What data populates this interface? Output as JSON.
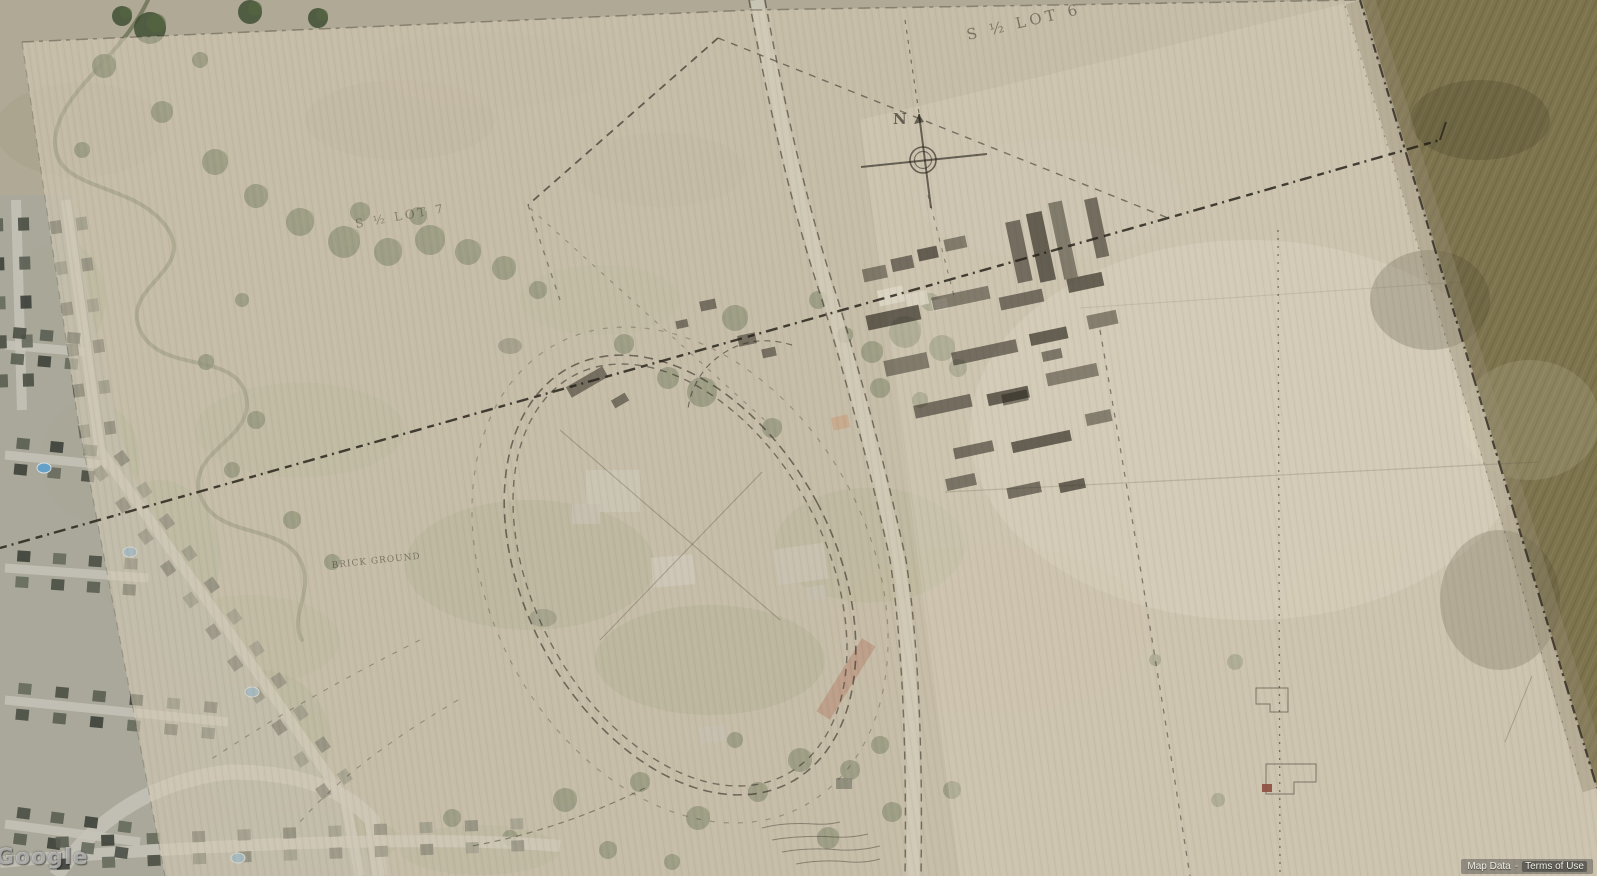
{
  "viewport": {
    "description": "Satellite aerial imagery with a semi-transparent historic survey map sheet overlaid",
    "width": 1597,
    "height": 876
  },
  "watermark": {
    "logo": "Google"
  },
  "attribution": {
    "map_data_label": "Map Data",
    "separator": "-",
    "terms_label": "Terms of Use"
  },
  "overlay_labels": {
    "lot6": "S ½ LOT 6",
    "lot7": "S ½ LOT 7",
    "north": "N",
    "brick_ground": "BRICK GROUND"
  },
  "icons": {
    "compass": "compass-rose-icon"
  },
  "colors": {
    "parchment": "#d5ccb6",
    "field_base": "#b0a995",
    "plowed_field": "#7d744e",
    "woodland": "#3f5233",
    "suburb_road": "#c6c3b7",
    "map_ink": "#2e2a22",
    "pool": "#64a0c8",
    "red_roof_building": "#9b5e49"
  }
}
